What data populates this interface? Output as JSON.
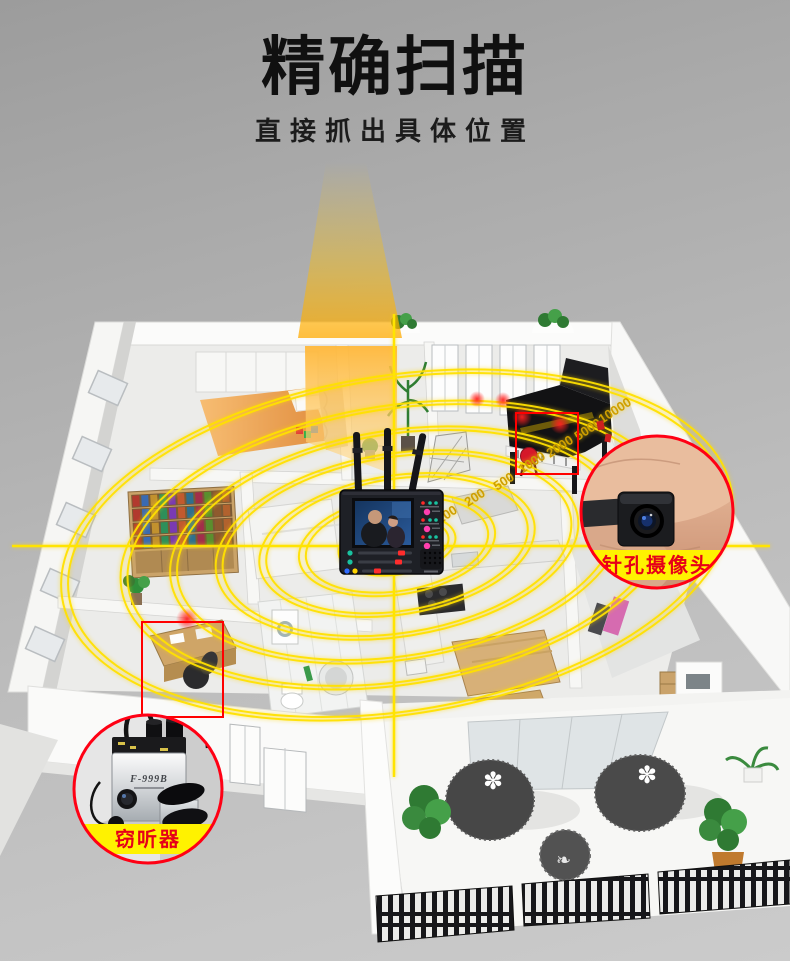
{
  "header": {
    "title": "精确扫描",
    "subtitle": "直接抓出具体位置"
  },
  "scan": {
    "ring_labels": [
      "100",
      "200",
      "500",
      "1000",
      "2000",
      "5000",
      "10000"
    ],
    "ring_color": "#ffe100",
    "crosshair_color": "#ffe400",
    "label_color": "#cf9f00"
  },
  "callouts": {
    "camera": {
      "label": "针孔摄像头",
      "band_color": "#fff200",
      "text_color": "#e60018",
      "border_color": "#ff0014",
      "photo": "finger-holding-pinhole-camera"
    },
    "wiretap": {
      "label": "窃听器",
      "device_marking": "F-999B",
      "band_color": "#fff200",
      "text_color": "#e60018",
      "border_color": "#ff0014",
      "photo": "f999b-wall-listening-device"
    }
  },
  "detector": {
    "name": "rf-detector-with-monitor",
    "antennas": 3,
    "screen": "surveillance-video-couple",
    "indicator_colors": [
      "#ff2a2a",
      "#ff3fae",
      "#19c2a0",
      "#2f6bff",
      "#ffd400"
    ]
  }
}
